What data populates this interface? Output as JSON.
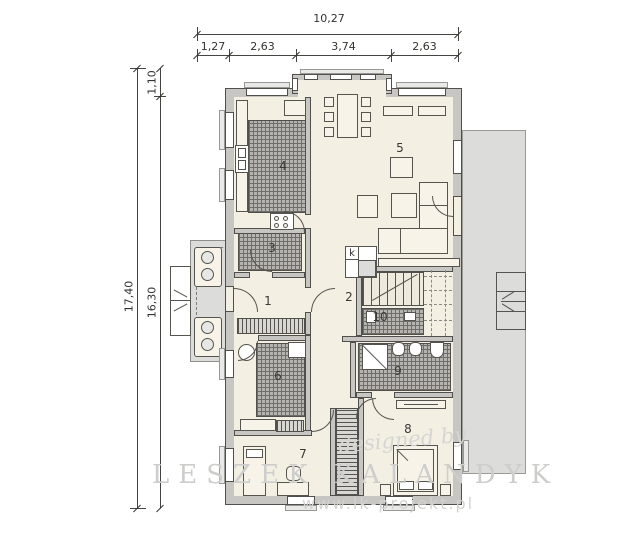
{
  "dimensions": {
    "top": {
      "total": "10,27",
      "segments": [
        "1,27",
        "2,63",
        "3,74",
        "2,63"
      ]
    },
    "left": {
      "outer": "17,40",
      "inner": "16,30",
      "offset": "1,10"
    }
  },
  "rooms": {
    "r1": "1",
    "r2": "2",
    "r3": "3",
    "r4": "4",
    "r5": "5",
    "r6": "6",
    "r7": "7",
    "r8": "8",
    "r9": "9",
    "r10": "10"
  },
  "annotations": {
    "fireplace_label": "k"
  },
  "watermark": {
    "script": "designed by",
    "author": "LESZEK KALANDYK",
    "url": "www.lk-projekt.pl"
  },
  "colors": {
    "floor": "#f4efe3",
    "wall_fill": "#c7c6c2",
    "wall_line": "#504f4b",
    "terrace": "#dcdcda",
    "hatch": "#6e6d69",
    "watermark": "#cdcdcb"
  }
}
